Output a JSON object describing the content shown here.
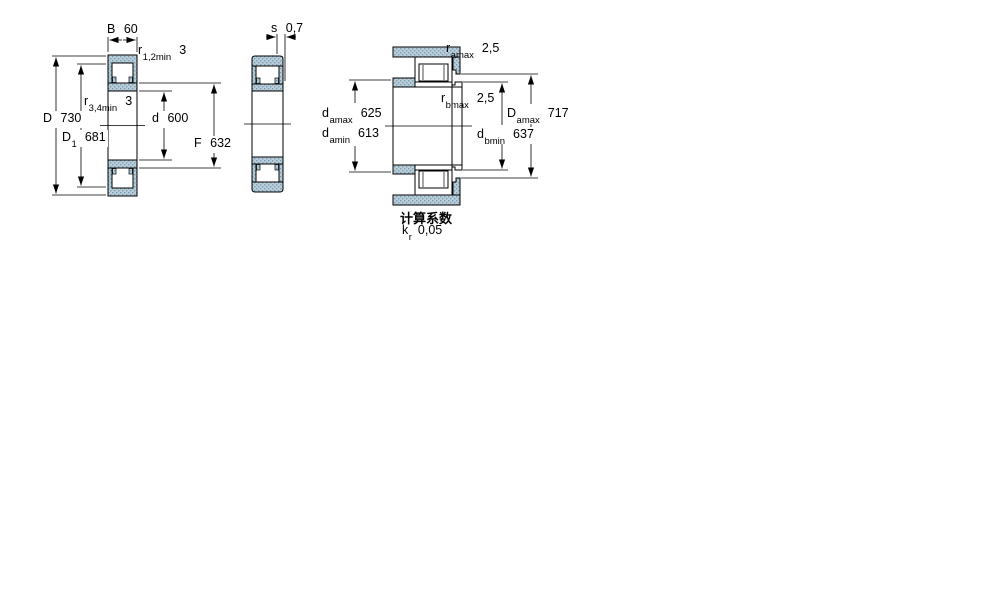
{
  "figures": {
    "cross_section": {
      "description": "bearing cross-section view",
      "dims": {
        "B": {
          "symbol": "B",
          "sub": "",
          "value": "60"
        },
        "r12": {
          "symbol": "r",
          "sub": "1,2min",
          "value": "3"
        },
        "r34": {
          "symbol": "r",
          "sub": "3,4min",
          "value": "3"
        },
        "D": {
          "symbol": "D",
          "sub": "",
          "value": "730"
        },
        "D1": {
          "symbol": "D",
          "sub": "1",
          "value": "681"
        },
        "d": {
          "symbol": "d",
          "sub": "",
          "value": "600"
        },
        "F": {
          "symbol": "F",
          "sub": "",
          "value": "632"
        }
      }
    },
    "side_view": {
      "description": "bearing side view with axial displacement",
      "dims": {
        "s": {
          "symbol": "s",
          "sub": "",
          "value": "0,7"
        }
      }
    },
    "mounting": {
      "description": "mounting / abutment dimensions view",
      "dims": {
        "ramax": {
          "symbol": "r",
          "sub": "amax",
          "value": "2,5"
        },
        "rbmax": {
          "symbol": "r",
          "sub": "bmax",
          "value": "2,5"
        },
        "damax": {
          "symbol": "d",
          "sub": "amax",
          "value": "625"
        },
        "damin": {
          "symbol": "d",
          "sub": "amin",
          "value": "613"
        },
        "dbmin": {
          "symbol": "d",
          "sub": "bmin",
          "value": "637"
        },
        "Damax": {
          "symbol": "D",
          "sub": "amax",
          "value": "717"
        }
      },
      "calculation_factors": {
        "title": "计算系数",
        "kr": {
          "symbol": "k",
          "sub": "r",
          "value": "0,05"
        }
      }
    }
  },
  "colors": {
    "section_fill": "#b9cedb",
    "section_dot": "#7e9db1",
    "line": "#000000",
    "background": "#ffffff"
  }
}
